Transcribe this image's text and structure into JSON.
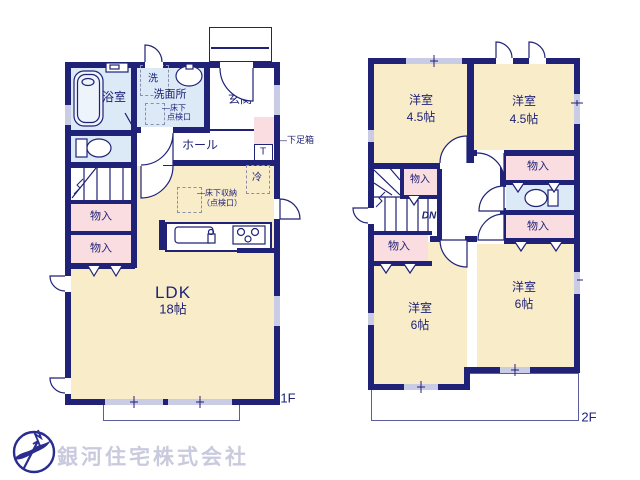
{
  "floor1": {
    "floor_label": "1F",
    "bathroom": "浴室",
    "washer": "洗",
    "washroom": "洗面所",
    "underfloor_hatch_line1": "―床下",
    "underfloor_hatch_line2": "点検口",
    "entrance": "玄関",
    "hall": "ホール",
    "shoe_box": "―下足箱",
    "shoe_box_t": "T",
    "fridge": "冷",
    "up": "UP",
    "underfloor_storage_line1": "―床下収納",
    "underfloor_storage_line2": "（点検口）",
    "closet1": "物入",
    "closet2": "物入",
    "ldk": "LDK",
    "ldk_size": "18帖"
  },
  "floor2": {
    "floor_label": "2F",
    "room_nw": "洋室",
    "room_nw_size": "4.5帖",
    "room_ne": "洋室",
    "room_ne_size": "4.5帖",
    "room_sw": "洋室",
    "room_sw_size": "6帖",
    "room_se": "洋室",
    "room_se_size": "6帖",
    "closet_stairs": "物入",
    "closet_ne": "物入",
    "closet_e": "物入",
    "closet_w": "物入",
    "dn": "DN"
  },
  "company": {
    "name": "銀河住宅株式会社"
  },
  "colors": {
    "wall": "#1f2277",
    "room": "#f8ecc9",
    "closet": "#fadde0",
    "wet": "#dce9f6",
    "window": "#c9cce4",
    "logo_text": "#c9cade"
  }
}
